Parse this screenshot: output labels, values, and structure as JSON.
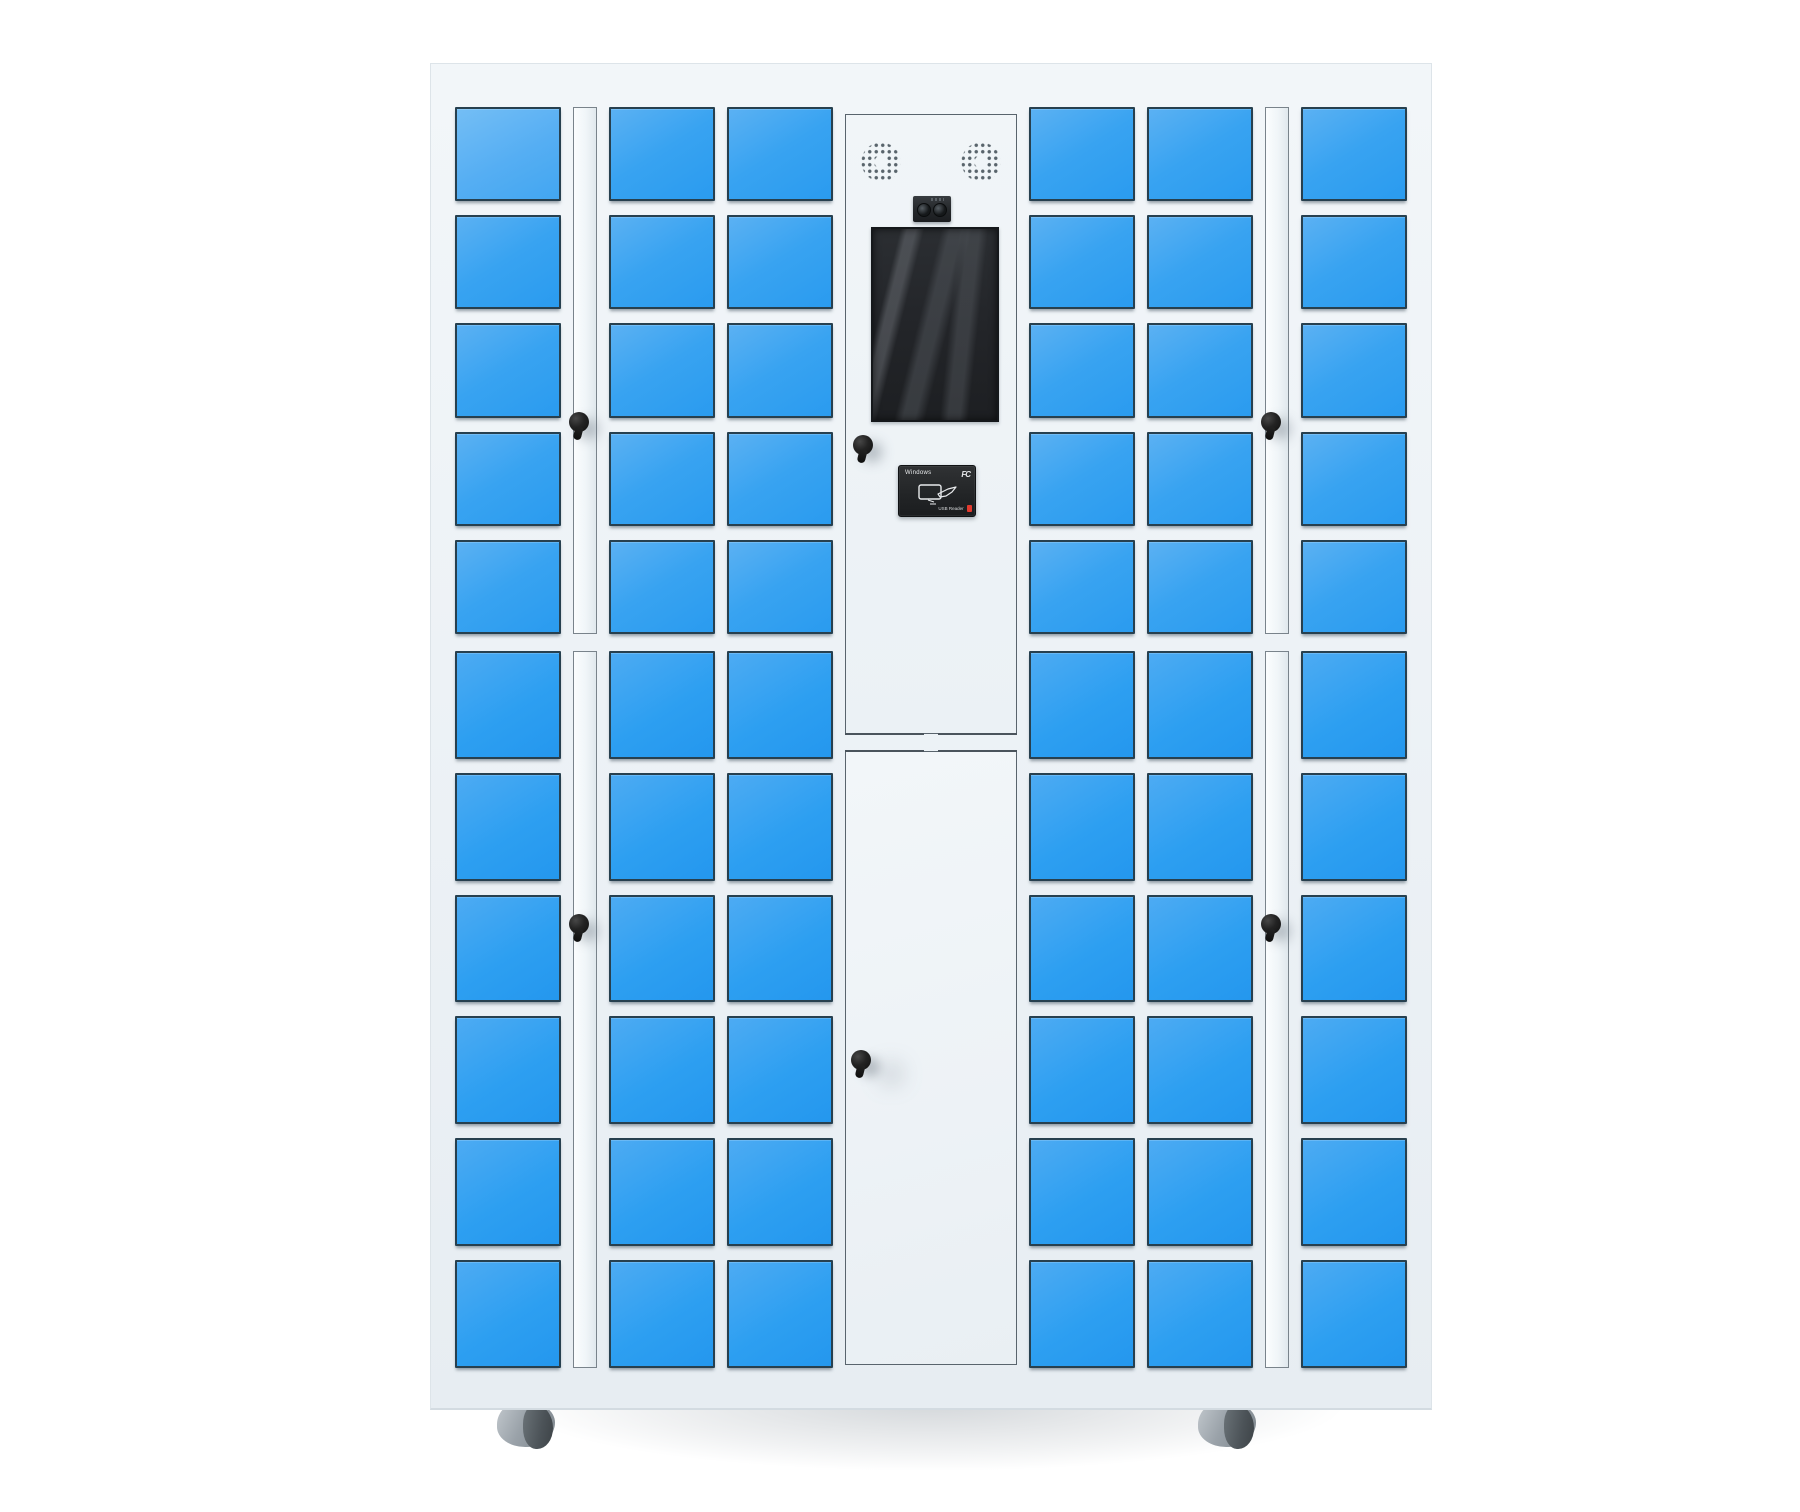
{
  "product": {
    "name": "smart-locker-cabinet",
    "description": "White electronic smart locker cabinet with blue compartment doors, central control panel (speakers, camera, touch screen, key lock, RFID card reader), key-locked side strips, central service door and caster wheels"
  },
  "structure": {
    "upper_rows": 5,
    "lower_rows": 6,
    "door_columns_left": 3,
    "door_columns_right": 3,
    "lock_strips": 2,
    "wheels_visible": 2
  },
  "control_panel": {
    "card_reader": {
      "brand_label": "Windows",
      "cert_label": "FC",
      "port_label": "USB Reader"
    }
  },
  "colors": {
    "door_blue": "#2d9ff1",
    "door_blue_light": "#5bb1f3",
    "door_border": "#27404f",
    "cabinet_white": "#edf2f6",
    "strip_border": "#79838b",
    "key_black": "#1b1b1b",
    "screen_dark": "#232529",
    "reader_black": "#222426",
    "reader_red": "#e23a2e",
    "wheel_gray": "#9aa2a9"
  }
}
